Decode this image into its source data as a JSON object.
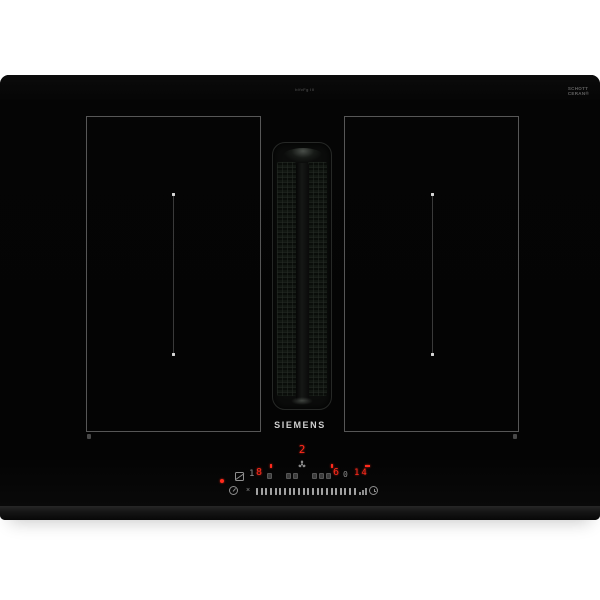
{
  "product": {
    "brand": "SIEMENS",
    "top_marking": "b/fvFg III",
    "glass_marking": [
      "SCHOTT",
      "CERAN®"
    ]
  },
  "display": {
    "hood_level": "2",
    "left_zone": {
      "aux": "1",
      "level": "8"
    },
    "right_zone": {
      "level": "6",
      "aux": "0"
    },
    "timer_minutes": "14",
    "slider_off_glyph": "×"
  },
  "slider": {
    "tick_count": 22
  },
  "icons": {
    "hood_fan": "fan-3-blades",
    "pan_move": "square-with-diagonal",
    "timer": "kitchen-timer-circle",
    "clock": "clock-face",
    "power_ramp": "three-rising-bars"
  },
  "colors": {
    "led_red": "#ff2a1c",
    "icon_gray": "#8f8f8f",
    "glass_black": "#060606",
    "background": "#ffffff"
  }
}
